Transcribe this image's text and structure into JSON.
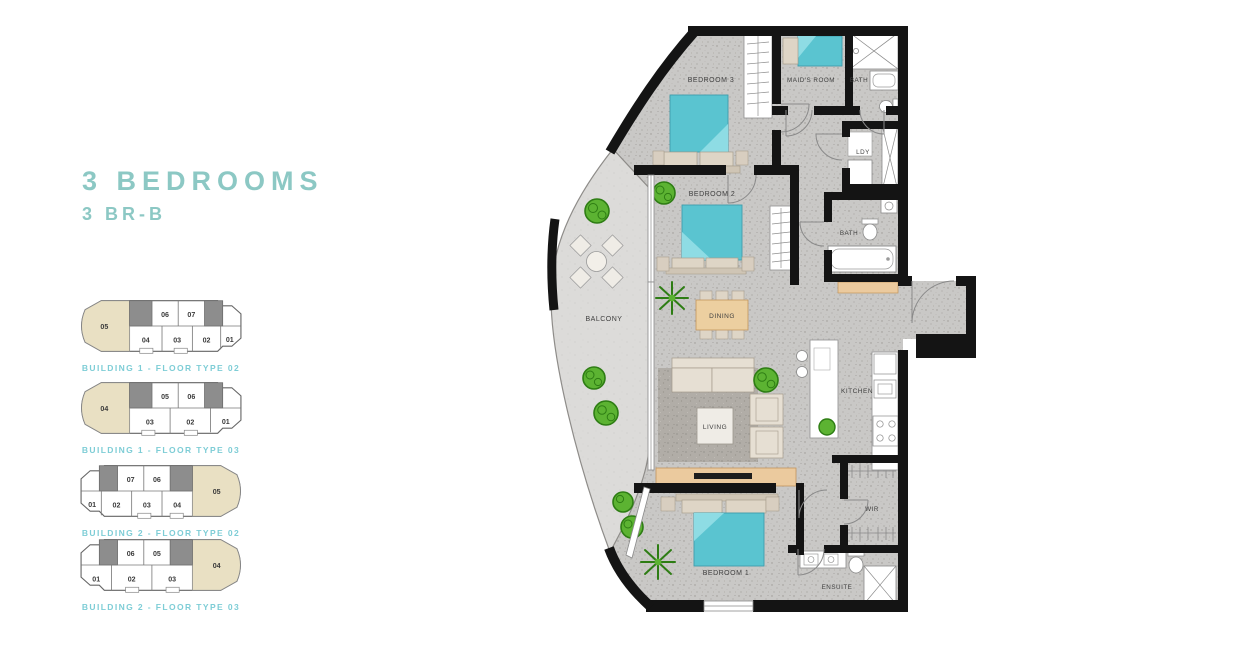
{
  "title": {
    "heading": "3 BEDROOMS",
    "subheading": "3 BR-B"
  },
  "key_plans": [
    {
      "label": "BUILDING 1 - FLOOR TYPE 02",
      "highlighted_unit": "05",
      "top_units": [
        "06",
        "07"
      ],
      "bottom_units": [
        "04",
        "03",
        "02",
        "01"
      ]
    },
    {
      "label": "BUILDING 1 - FLOOR TYPE 03",
      "highlighted_unit": "04",
      "top_units": [
        "05",
        "06"
      ],
      "bottom_units": [
        "03",
        "02",
        "01"
      ]
    },
    {
      "label": "BUILDING 2 - FLOOR TYPE 02",
      "highlighted_unit": "05",
      "top_units": [
        "07",
        "06"
      ],
      "bottom_units": [
        "01",
        "02",
        "03",
        "04"
      ]
    },
    {
      "label": "BUILDING 2 - FLOOR TYPE 03",
      "highlighted_unit": "04",
      "top_units": [
        "06",
        "05"
      ],
      "bottom_units": [
        "01",
        "02",
        "03"
      ]
    }
  ],
  "floor_plan": {
    "rooms": {
      "bedroom_3": "BEDROOM 3",
      "maids_room": "MAID'S ROOM",
      "bath_top": "BATH",
      "ldy": "LDY",
      "bedroom_2": "BEDROOM 2",
      "bath_mid": "BATH",
      "balcony": "BALCONY",
      "dining": "DINING",
      "kitchen": "KITCHEN",
      "living": "LIVING",
      "wir": "WIR",
      "bedroom_1": "BEDROOM 1",
      "ensuite": "ENSUITE"
    }
  },
  "colors": {
    "accent_teal": "#8cc8c4",
    "key_plan_label_teal": "#7ecdd6",
    "bed_teal": "#5ac4d0",
    "highlight_beige": "#e9e0c3",
    "core_gray": "#8d8d8d",
    "wall_black": "#141414",
    "wood_tan": "#ebca9e"
  }
}
